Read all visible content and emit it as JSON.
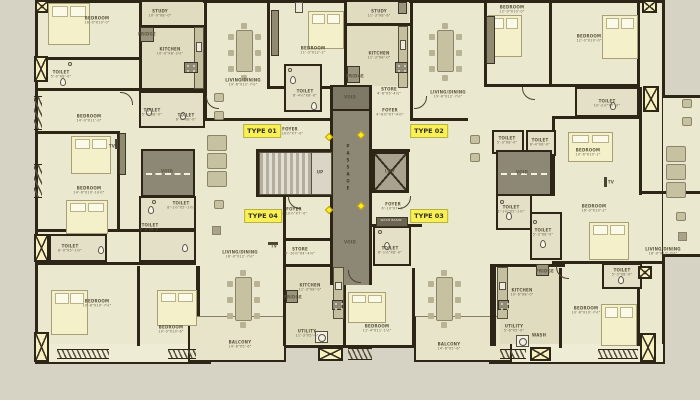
{
  "plan_name": "apartment-typical-floor-plan",
  "colors": {
    "background": "#d6d2c4",
    "floor": "#ebe8d0",
    "wall": "#2d2617",
    "core_gray": "#8d8875",
    "type_label_yellow": "#f9f055",
    "duct_yellow": "#f7f2c0",
    "bed_cream": "#f4f1ca",
    "furniture_olive": "#c6c2a1"
  },
  "unit_types": [
    {
      "label": "TYPE 01",
      "x": 262,
      "y": 131
    },
    {
      "label": "TYPE 02",
      "x": 429,
      "y": 131
    },
    {
      "label": "TYPE 03",
      "x": 429,
      "y": 216
    },
    {
      "label": "TYPE 04",
      "x": 263,
      "y": 216
    }
  ],
  "room_labels": [
    {
      "n": "BEDROOM",
      "d": "16'-0\"X10'-0\"",
      "x": 97,
      "y": 20
    },
    {
      "n": "TOILET",
      "d": "5'-0\"X8'-0\"",
      "x": 61,
      "y": 74
    },
    {
      "n": "STUDY",
      "d": "10'-0\"X8'-0\"",
      "x": 160,
      "y": 13
    },
    {
      "n": "KITCHEN",
      "d": "10'-0\"X8'-2½\"",
      "x": 170,
      "y": 51
    },
    {
      "n": "FRIDGE",
      "x": 147,
      "y": 34
    },
    {
      "n": "TOILET",
      "d": "5'-3\"X8'-0\"",
      "x": 152,
      "y": 112
    },
    {
      "n": "TOILET",
      "d": "6'-4\"X8'-0\"",
      "x": 186,
      "y": 117
    },
    {
      "n": "BEDROOM",
      "d": "14'-0\"X11'-0\"",
      "x": 89,
      "y": 118
    },
    {
      "n": "LIVING/DINING",
      "d": "19'-6\"X12'-7½\"",
      "x": 243,
      "y": 82
    },
    {
      "n": "BEDROOM",
      "d": "11'-3\"X12'-2\"",
      "x": 313,
      "y": 50
    },
    {
      "n": "TOILET",
      "d": "6'-4½\"X8'-0\"",
      "x": 305,
      "y": 93
    },
    {
      "n": "STUDY",
      "d": "11'-3\"X8'-6\"",
      "x": 379,
      "y": 13
    },
    {
      "n": "KITCHEN",
      "d": "11'-3\"X8'-0\"",
      "x": 379,
      "y": 55
    },
    {
      "n": "FRIDGE",
      "x": 355,
      "y": 76
    },
    {
      "n": "STORE",
      "d": "4'-6\"X5'-4½\"",
      "x": 389,
      "y": 91
    },
    {
      "n": "FOYER",
      "d": "4'-6½\"X7'-4½\"",
      "x": 390,
      "y": 112
    },
    {
      "n": "LIVING/DINING",
      "d": "19'-6\"X12'-7½\"",
      "x": 448,
      "y": 94
    },
    {
      "n": "BEDROOM",
      "d": "12'-0\"X10'-0\"",
      "x": 512,
      "y": 9
    },
    {
      "n": "BEDROOM",
      "d": "12'-0\"X10'-0\"",
      "x": 589,
      "y": 38
    },
    {
      "n": "TOILET",
      "d": "10'-2½\"X5'-0\"",
      "x": 607,
      "y": 103
    },
    {
      "n": "FOYER",
      "d": "6'-10½\"X7'-0\"",
      "x": 290,
      "y": 131
    },
    {
      "n": "BEDROOM",
      "d": "14'-6\"X10'-10½\"",
      "x": 89,
      "y": 190
    },
    {
      "n": "VOID",
      "x": 167,
      "y": 171
    },
    {
      "n": "TOILET",
      "d": "8'-1½\"X5'-1½\"",
      "x": 181,
      "y": 205
    },
    {
      "n": "TOILET",
      "d": "5'-3\"X8'-0\"",
      "x": 150,
      "y": 227
    },
    {
      "n": "TOILET",
      "d": "8'-0\"X5'-1½\"",
      "x": 70,
      "y": 248
    },
    {
      "n": "TV",
      "x": 112,
      "y": 146
    },
    {
      "n": "PASSAGE",
      "x": 348,
      "y": 168,
      "v": true
    },
    {
      "n": "UP",
      "x": 320,
      "y": 172
    },
    {
      "n": "LIFT",
      "x": 390,
      "y": 171
    },
    {
      "n": "VOID",
      "x": 350,
      "y": 97
    },
    {
      "n": "VOID",
      "x": 350,
      "y": 242
    },
    {
      "n": "FOYER",
      "d": "6'-10½\"X7'-0\"",
      "x": 294,
      "y": 211
    },
    {
      "n": "STORE",
      "d": "6'-10½\"X4'-4½\"",
      "x": 300,
      "y": 251
    },
    {
      "n": "FOYER",
      "d": "6'-10\"X7'-0\"",
      "x": 393,
      "y": 206
    },
    {
      "n": "WASH BASIN",
      "x": 391,
      "y": 221,
      "light": true
    },
    {
      "n": "TOILET",
      "d": "6'-1½\"X8'-0\"",
      "x": 390,
      "y": 250
    },
    {
      "n": "VOID",
      "x": 522,
      "y": 172
    },
    {
      "n": "TOILET",
      "d": "5'-3\"X8'-0\"",
      "x": 507,
      "y": 140
    },
    {
      "n": "TOILET",
      "d": "6'-4\"X8'-0\"",
      "x": 540,
      "y": 142
    },
    {
      "n": "TOILET",
      "d": "8'-1½\"X5'-1½\"",
      "x": 511,
      "y": 209
    },
    {
      "n": "TOILET",
      "d": "5'-3\"X8'-0\"",
      "x": 543,
      "y": 232
    },
    {
      "n": "BEDROOM",
      "d": "10'-6\"X10'-2\"",
      "x": 588,
      "y": 152
    },
    {
      "n": "TV",
      "x": 611,
      "y": 182
    },
    {
      "n": "BEDROOM",
      "d": "16'-0\"X10'-2\"",
      "x": 594,
      "y": 208
    },
    {
      "n": "LIVING/DINING",
      "d": "16'-0\"X12'-7½\"",
      "x": 240,
      "y": 254
    },
    {
      "n": "TV",
      "x": 274,
      "y": 246
    },
    {
      "n": "LIVING/DINING",
      "d": "16'-0\"X12'-7½\"",
      "x": 663,
      "y": 251
    },
    {
      "n": "BEDROOM",
      "d": "10'-6\"X10'-7½\"",
      "x": 97,
      "y": 303
    },
    {
      "n": "BEDROOM",
      "d": "10'-0\"X10'-6\"",
      "x": 171,
      "y": 329
    },
    {
      "n": "KITCHEN",
      "d": "11'-3\"X8'-0\"",
      "x": 310,
      "y": 287
    },
    {
      "n": "FRIDGE",
      "x": 293,
      "y": 297
    },
    {
      "n": "UTILITY",
      "d": "11'-3\"X5'-6\"",
      "x": 307,
      "y": 333
    },
    {
      "n": "BEDROOM",
      "d": "11'-4\"X11'-1½\"",
      "x": 377,
      "y": 328
    },
    {
      "n": "BALCONY",
      "d": "14'-6\"X5'-6\"",
      "x": 240,
      "y": 344
    },
    {
      "n": "BALCONY",
      "d": "14'-6\"X5'-6\"",
      "x": 449,
      "y": 346
    },
    {
      "n": "KITCHEN",
      "d": "10'-6\"X8'-0\"",
      "x": 522,
      "y": 292
    },
    {
      "n": "FRIDGE",
      "x": 545,
      "y": 271
    },
    {
      "n": "UTILITY",
      "d": "5'-6\"X5'-0\"",
      "x": 514,
      "y": 328
    },
    {
      "n": "WASH",
      "x": 539,
      "y": 335
    },
    {
      "n": "BEDROOM",
      "d": "10'-6\"X10'-7½\"",
      "x": 586,
      "y": 310
    },
    {
      "n": "TOILET",
      "d": "5'-3\"X8'-0\"",
      "x": 622,
      "y": 272
    }
  ]
}
